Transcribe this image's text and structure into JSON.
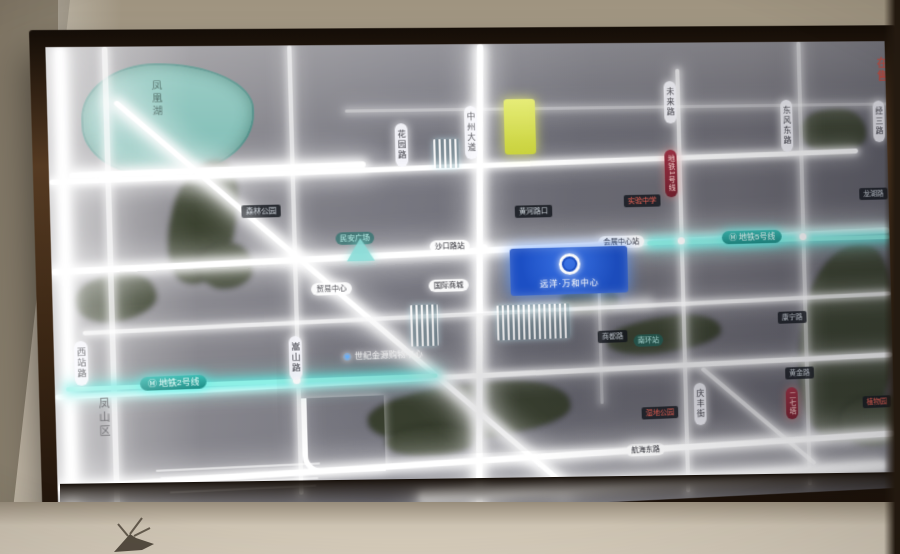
{
  "photo": {
    "district_label": "凤山区",
    "wall_sign_text": "在售"
  },
  "map": {
    "lake_label": "凤凰湖",
    "plaque": {
      "brand_name": "远洋·万和中心"
    },
    "metro_icon": "Ⓜ",
    "metro_line_2": "地铁2号线",
    "metro_line_5": "地铁5号线",
    "metro_line_1_vertical": "地铁1号线",
    "vroads": [
      "花园路",
      "中州大道",
      "未来路",
      "东风东路",
      "经三路",
      "西站路",
      "嵩山路",
      "庆丰街"
    ],
    "stations": [
      "沙口路站",
      "会展中心站",
      "民安广场",
      "南环站"
    ],
    "dark_plates": [
      "黄河路口",
      "实验中学",
      "森林公园",
      "商都路",
      "康宁路",
      "黄金路",
      "龙湖路"
    ],
    "light_plates": [
      "贸易中心",
      "国际商城"
    ],
    "poi_mall_icon": "◉",
    "poi_mall": "世纪金源购物中心",
    "red_labels": [
      "湿地公园",
      "植物园",
      "二七塔"
    ],
    "bottom_road": "航海东路"
  }
}
